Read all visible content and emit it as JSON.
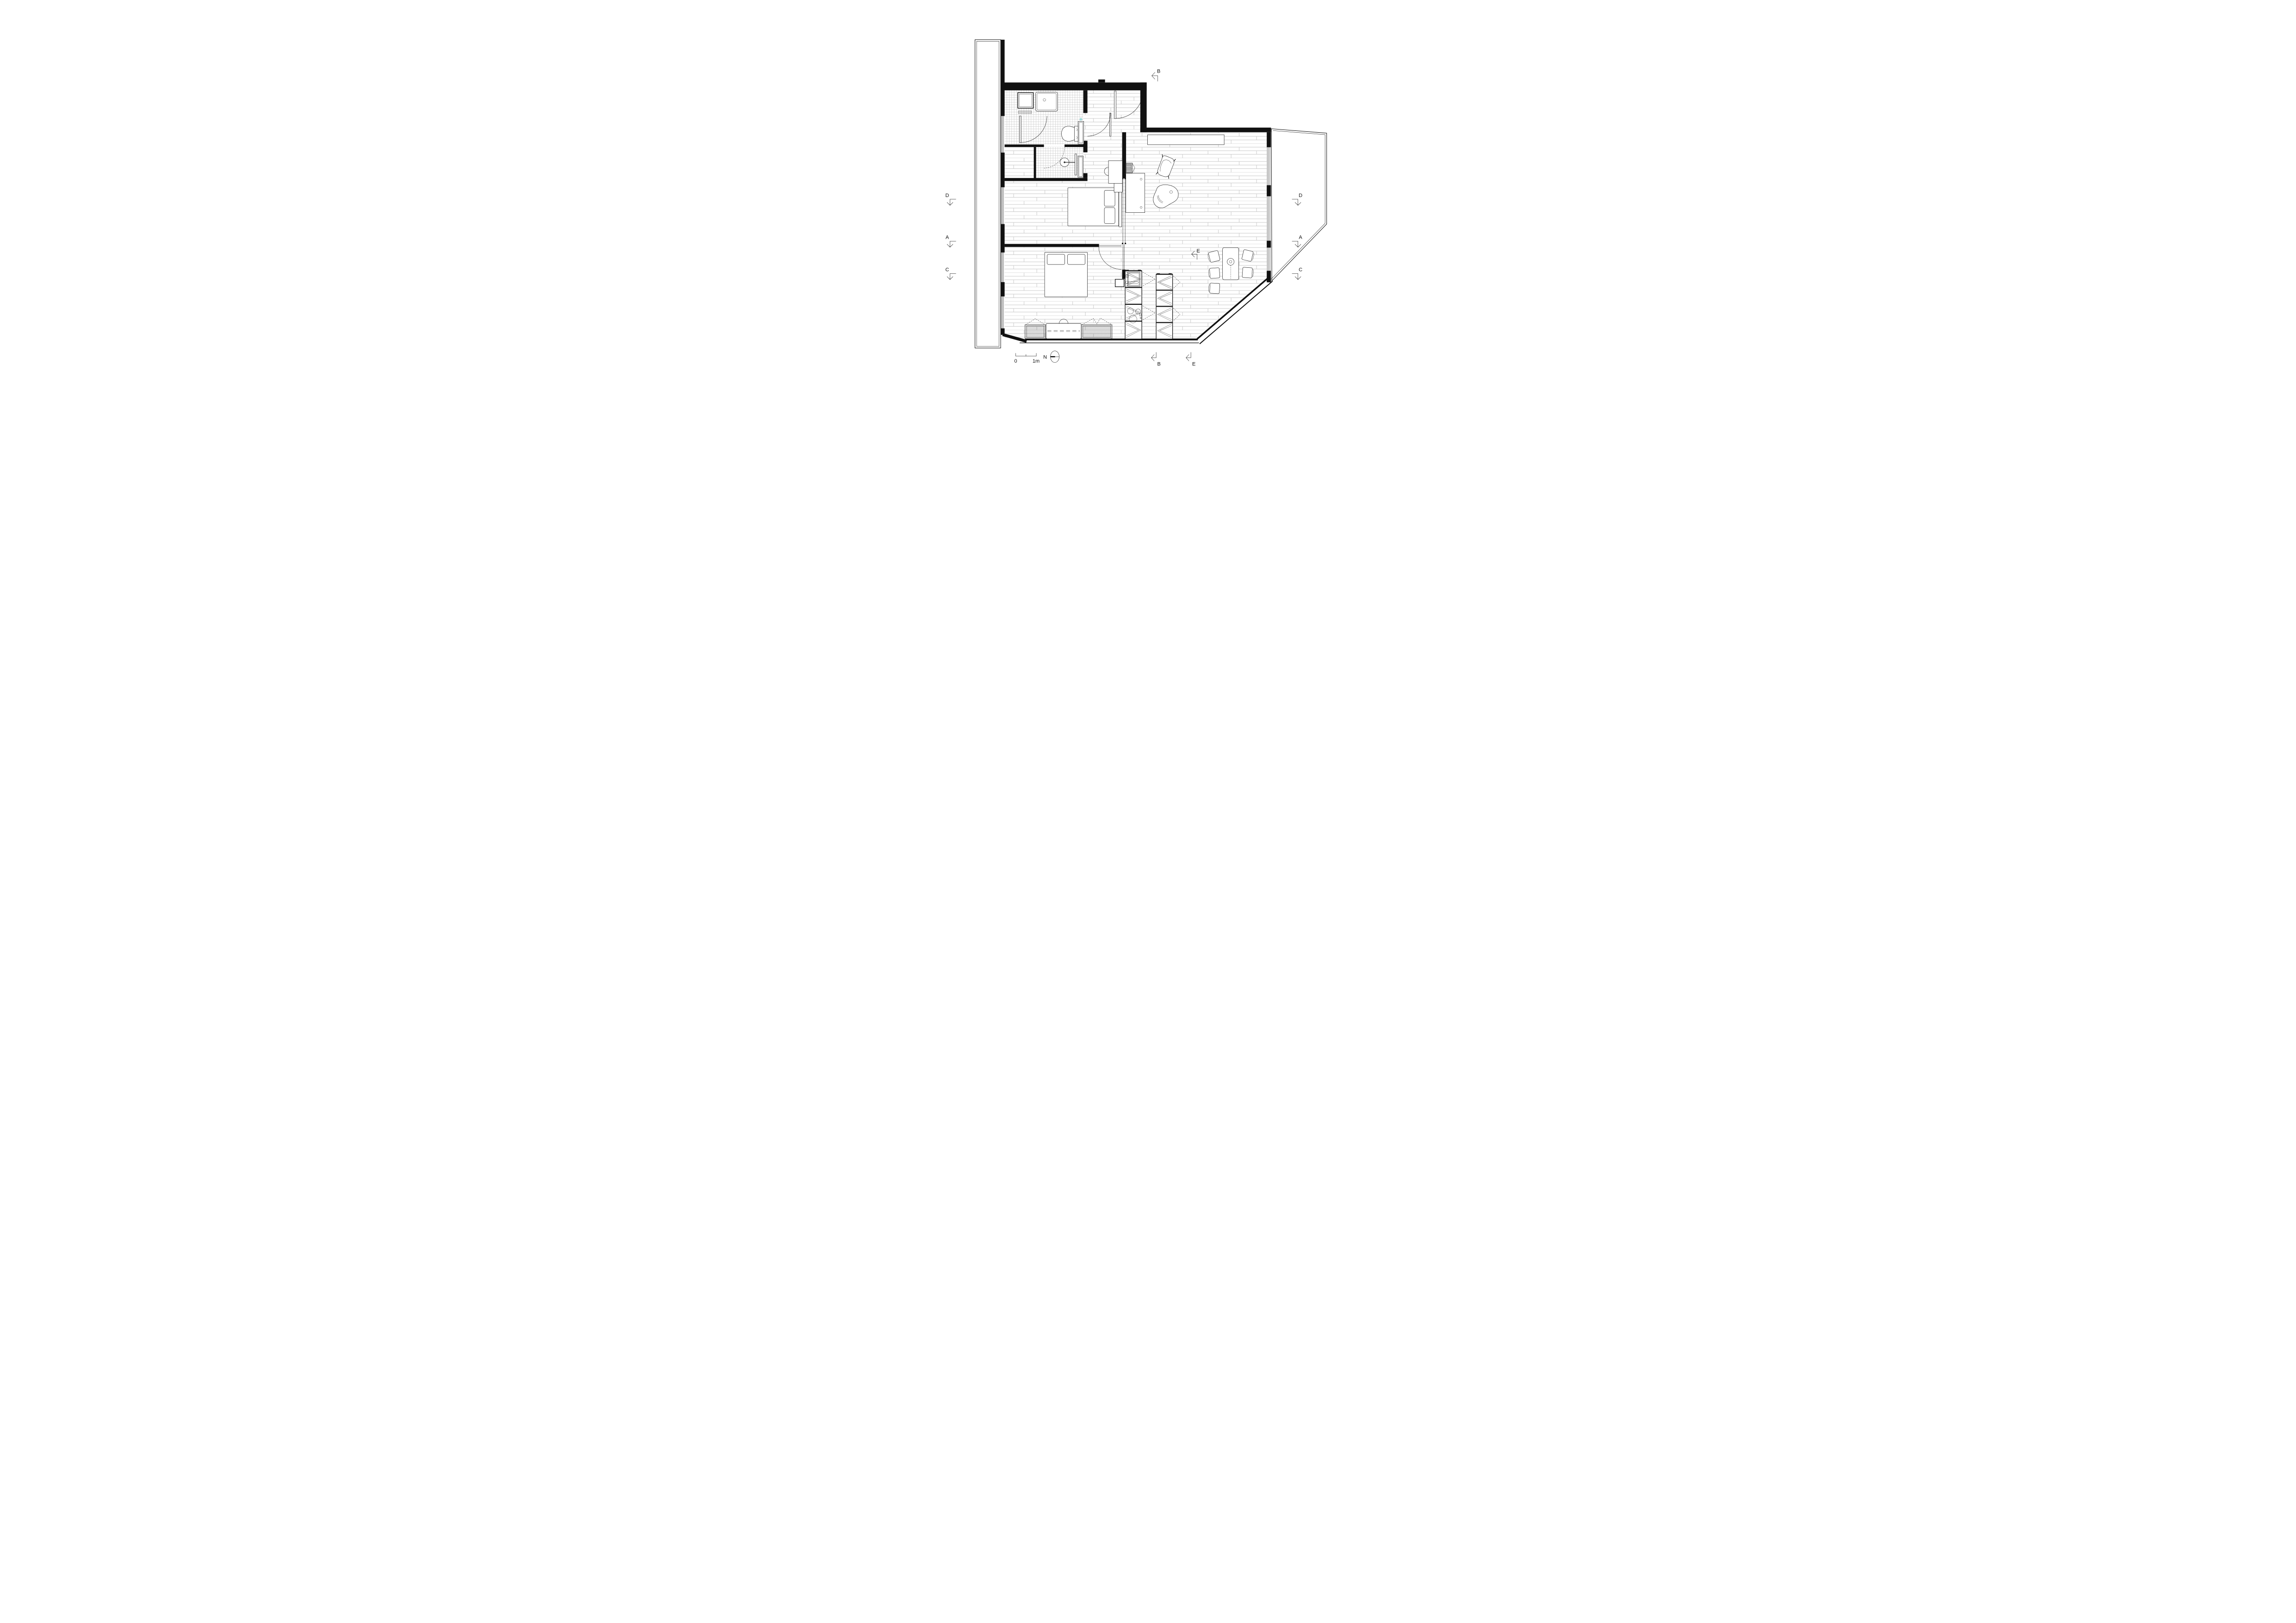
{
  "drawing": {
    "kind": "apartment floor plan",
    "scale_bar": {
      "zero": "0",
      "one_meter": "1m"
    },
    "north_arrow": {
      "label": "N"
    },
    "section_markers": {
      "top_b": "B",
      "left_d": "D",
      "left_a": "A",
      "left_c": "C",
      "right_d": "D",
      "right_a": "A",
      "right_c": "C",
      "bottom_b": "B",
      "bottom_e": "E",
      "interior_e": "E"
    },
    "colors": {
      "ink": "#111111",
      "plank_line": "#c9c9c9",
      "tile_line": "#c3c3c3",
      "accent_cross": "#2fb3b3",
      "background": "#ffffff"
    },
    "icons": {
      "north": "north-compass-icon",
      "section_arrow": "section-cut-arrow-icon",
      "door": "door-swing-arc",
      "pendant": "pendant-lamp-icon"
    }
  }
}
